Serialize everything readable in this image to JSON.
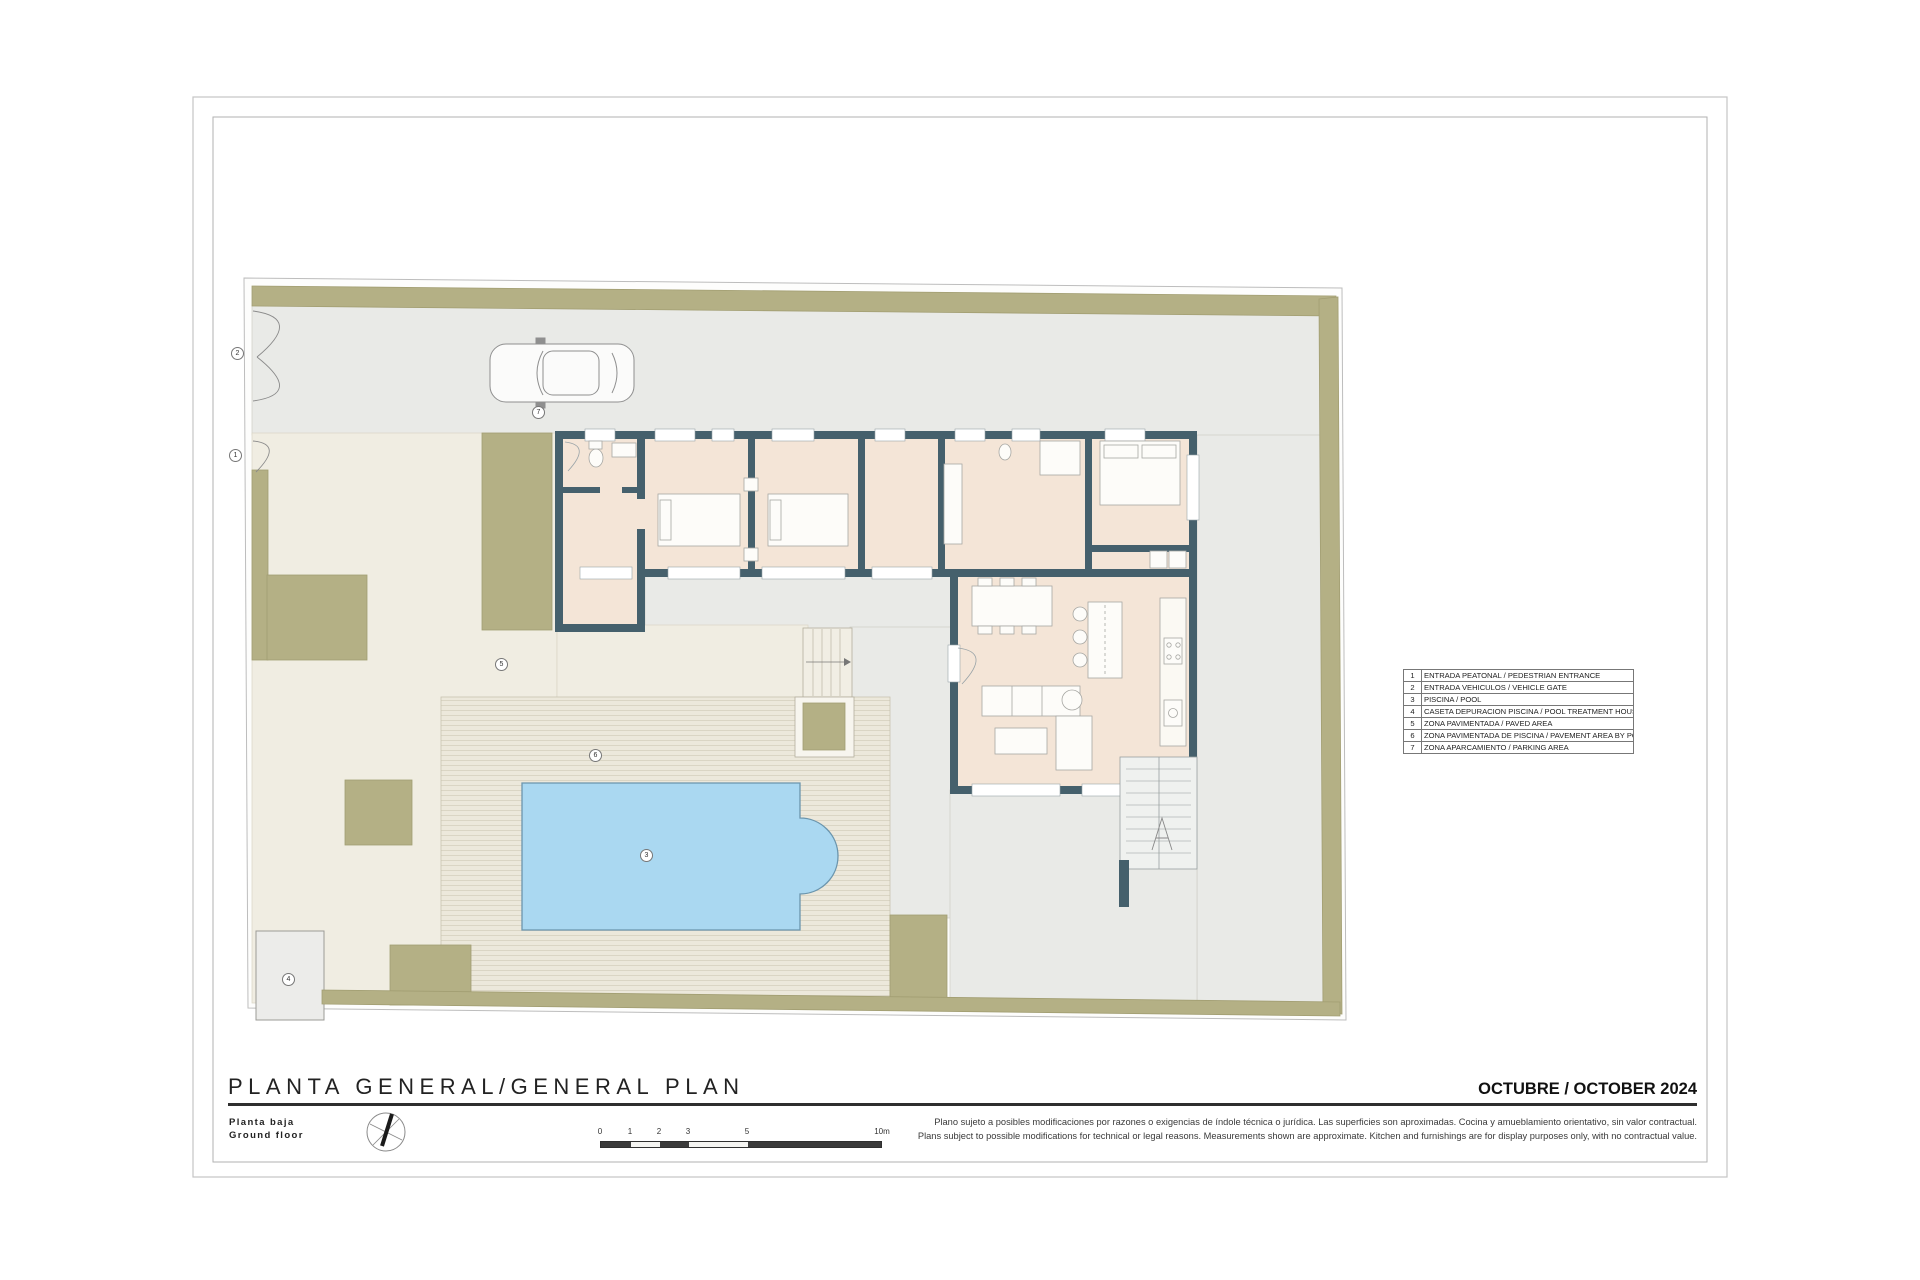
{
  "sheet": {
    "title": "PLANTA GENERAL/GENERAL PLAN",
    "floor_es": "Planta baja",
    "floor_en": "Ground floor",
    "date": "OCTUBRE / OCTOBER 2024",
    "disclaimer_es": "Plano sujeto a posibles modificaciones por razones o exigencias de índole técnica o jurídica. Las superficies son aproximadas. Cocina y amueblamiento orientativo, sin valor contractual.",
    "disclaimer_en": "Plans subject to possible modifications for technical or legal reasons. Measurements shown are approximate. Kitchen and furnishings are for display purposes only, with no contractual value."
  },
  "legend": {
    "rows": [
      {
        "num": "1",
        "label": "ENTRADA PEATONAL / PEDESTRIAN ENTRANCE"
      },
      {
        "num": "2",
        "label": "ENTRADA VEHICULOS / VEHICLE GATE"
      },
      {
        "num": "3",
        "label": "PISCINA / POOL"
      },
      {
        "num": "4",
        "label": "CASETA DEPURACION PISCINA / POOL TREATMENT HOUSE"
      },
      {
        "num": "5",
        "label": "ZONA PAVIMENTADA / PAVED AREA"
      },
      {
        "num": "6",
        "label": "ZONA PAVIMENTADA DE PISCINA / PAVEMENT AREA BY POOL"
      },
      {
        "num": "7",
        "label": "ZONA APARCAMIENTO / PARKING AREA"
      }
    ]
  },
  "scale_bar": {
    "ticks": [
      "0",
      "1",
      "2",
      "3",
      "5",
      "10m"
    ]
  },
  "plan": {
    "markers": [
      {
        "num": "1"
      },
      {
        "num": "2"
      },
      {
        "num": "3"
      },
      {
        "num": "4"
      },
      {
        "num": "5"
      },
      {
        "num": "6"
      },
      {
        "num": "7"
      }
    ]
  },
  "colors": {
    "hedge_green": "#b4b085",
    "pool_blue": "#aad8f1",
    "wall_slate": "#45606c",
    "interior_peach": "#f4e5d7",
    "paved_cream": "#f0ede2",
    "terrace_gray": "#e9eae7",
    "deck_beige": "#ece8db"
  }
}
